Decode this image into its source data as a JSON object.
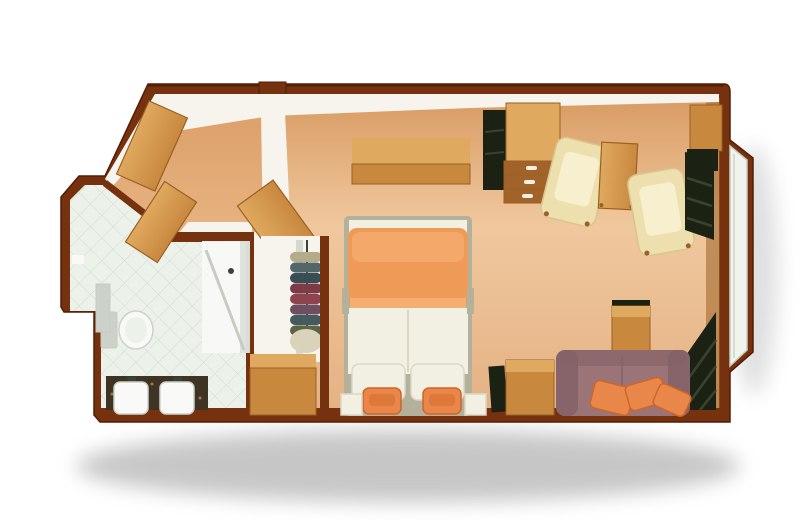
{
  "plan": {
    "type": "stateroom-floorplan",
    "rooms": {
      "bathroom": {
        "name": "bathroom",
        "floor": "tile",
        "furniture": [
          "toilet",
          "shower",
          "vanity-counter",
          "sink-1",
          "sink-2",
          "wall-shelf",
          "toilet-paper-holder"
        ]
      },
      "entry": {
        "name": "entry-vestibule",
        "floor": "carpet",
        "furniture": [
          "entry-door",
          "bathroom-door",
          "closet-door"
        ]
      },
      "bedroom": {
        "name": "bedroom",
        "floor": "carpet",
        "furniture": [
          "double-bed",
          "nightstand-left",
          "nightstand-right",
          "overhead-shelf",
          "closet",
          "clothes-rail",
          "laundry-bag",
          "dresser"
        ]
      },
      "sitting_area": {
        "name": "sitting-area",
        "floor": "carpet",
        "furniture": [
          "tv-panel",
          "vanity-cabinet",
          "vanity-drawers",
          "armchair-1",
          "side-table",
          "armchair-2",
          "corner-cabinet",
          "sofa",
          "sofa-pillows",
          "side-cabinet",
          "dark-bag",
          "sofa-side-table",
          "curtain-top",
          "curtain-bottom"
        ]
      },
      "window": {
        "name": "bay-window",
        "glazing": "picture-window",
        "drapes": "dark"
      }
    },
    "counts": {
      "sofa_pillows": 3,
      "bed_pillows": 2,
      "accent_pillows": 2,
      "armchairs": 2,
      "sinks": 2,
      "drawer_handles": 3
    }
  },
  "closet": {
    "clothes_colors": [
      "#b3ab8c",
      "#55666b",
      "#394d54",
      "#7c3b46",
      "#8e4450",
      "#6e4f60",
      "#455a5e",
      "#5d6347"
    ],
    "bag_color": "#d9d3bb"
  },
  "palette": {
    "background": "#ffffff",
    "wall": "#76310f",
    "wall_dark": "#541d04",
    "wall_face": "#f6f4ec",
    "floor_top": "#d89a62",
    "floor_mid": "#f0c89e",
    "floor_bottom": "#e4b285",
    "entry_floor": "#dfa069",
    "tile": "#ecf1ea",
    "tile_line": "#ccd7cb",
    "wood": "#c8883e",
    "wood_light": "#dfa95f",
    "wood_dark": "#9a6124",
    "drawer": "#a2632a",
    "cream_chair": "#eddfae",
    "cream_chair_inner": "#f7efce",
    "cream_edge": "#d9c58e",
    "sofa": "#9b7477",
    "sofa_dark": "#826066",
    "pillow": "#e9874a",
    "pillow_dark": "#cf6526",
    "bed_orange": "#f09a57",
    "bed_orange_light": "#f6b277",
    "bed_white": "#f2efe3",
    "bed_frame": "#b3b09c",
    "crease": "#ddd8c6",
    "drape": "#1b2214",
    "drape_line": "#39432d",
    "glass": "#f1f3ed",
    "glass_line": "#c6ccc1",
    "fixture_white": "#f9faf7",
    "fixture_gray": "#ccd2c9",
    "dark_fixture": "#3c4136",
    "marble": "#3f3423",
    "shadow": "#8f8f8f"
  }
}
